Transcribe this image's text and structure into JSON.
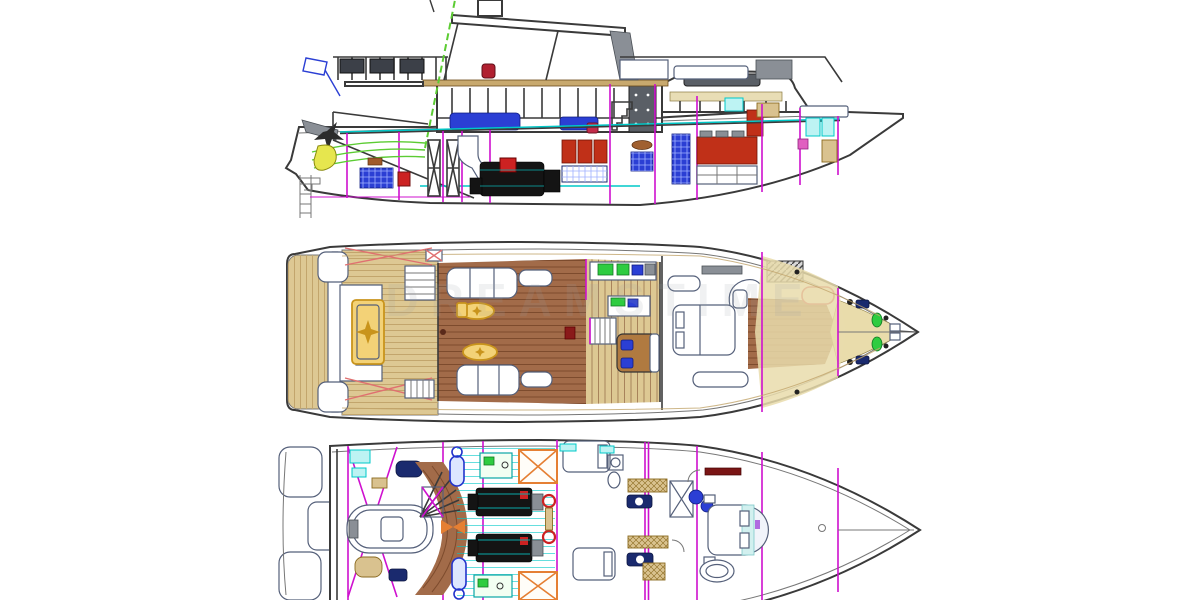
{
  "watermark": {
    "text": "DREAMSTIME"
  },
  "views": [
    {
      "id": "side-elevation",
      "position": "top"
    },
    {
      "id": "main-deck-plan",
      "position": "middle"
    },
    {
      "id": "lower-deck-plan",
      "position": "bottom"
    }
  ],
  "colors": {
    "hull_line": "#3a3a3a",
    "inner_line": "#777777",
    "bulkhead_magenta": "#cf10cf",
    "deck_cyan": "#00c8c8",
    "teak": "#ddc893",
    "teak_line": "#c2a56c",
    "wood_floor": "#a26b49",
    "wood_floor_line": "#7d4b2d",
    "foredeck_cream": "#e9dcab",
    "gold": "#f3d277",
    "gold_dark": "#c9941c",
    "furniture_line": "#55607a",
    "marine_blue": "#2b3fd4",
    "navy": "#1a2a6e",
    "appliance_green": "#2ecc40",
    "appliance_green_dark": "#117722",
    "tender_green": "#5ccc33",
    "outboard_yellow": "#e6e64e",
    "cabinet_red": "#c03018",
    "engine_black": "#141414",
    "accent_red": "#cc2222",
    "tank_orange": "#e57f33",
    "mooring_pink": "#e07070",
    "metal_gray": "#8a8f96",
    "hatch_tan": "#d9c28f",
    "watermark_gray": "#9aa0a6"
  }
}
